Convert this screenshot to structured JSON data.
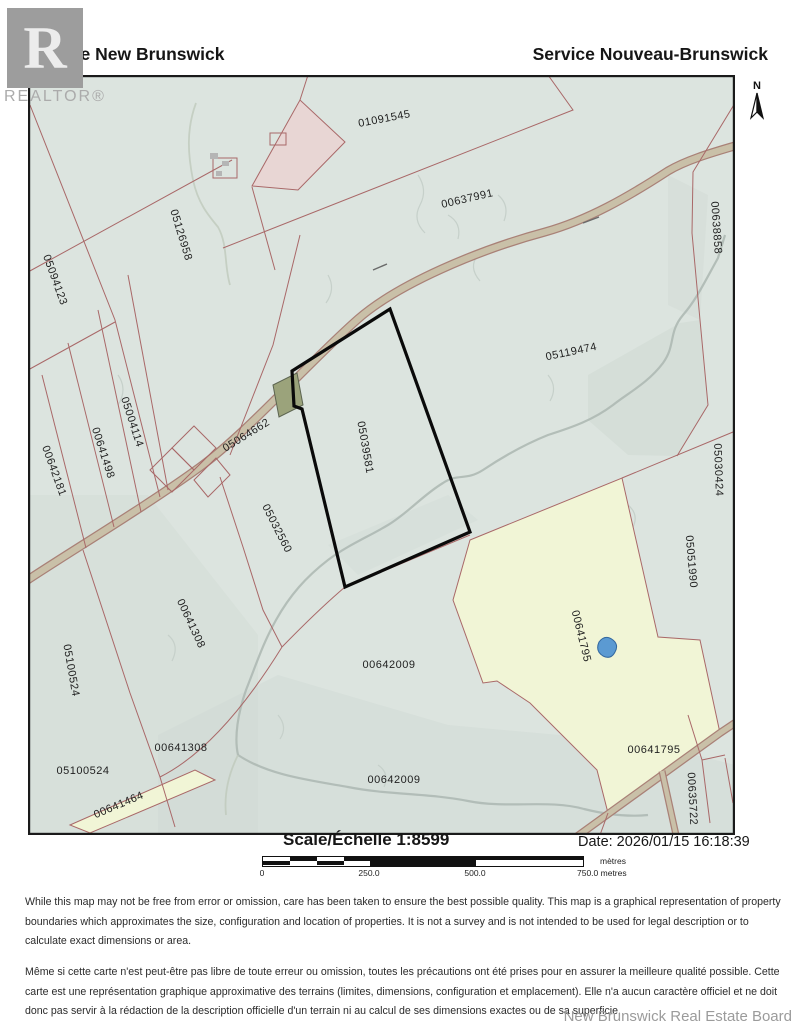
{
  "header": {
    "left_title": "Service New Brunswick",
    "right_title": "Service Nouveau-Brunswick",
    "realtor_letter": "R",
    "realtor_wordmark": "REALTOR®",
    "north_label": "N"
  },
  "map": {
    "subject_parcel_id": "05039581",
    "colors": {
      "c-redline": "#a96868",
      "c-road": "#c9c0a8",
      "c-roadedge": "#a98177",
      "c-subject": "#0a0a0a",
      "c-yellow": "#f1f5d6",
      "c-pink": "#e8d6d4",
      "c-olive": "#9ba37b",
      "c-pond": "#5b9ad2",
      "c-mapbg": "#dce4df"
    },
    "parcel_labels": [
      {
        "text": "01091545",
        "x": 357,
        "y": 47,
        "r": -11
      },
      {
        "text": "00637991",
        "x": 440,
        "y": 127,
        "r": -13
      },
      {
        "text": "00638858",
        "x": 685,
        "y": 153,
        "r": 86
      },
      {
        "text": "05126958",
        "x": 150,
        "y": 161,
        "r": 73
      },
      {
        "text": "05094123",
        "x": 24,
        "y": 206,
        "r": 70
      },
      {
        "text": "05119474",
        "x": 544,
        "y": 280,
        "r": -12
      },
      {
        "text": "05004114",
        "x": 101,
        "y": 348,
        "r": 72
      },
      {
        "text": "00641498",
        "x": 72,
        "y": 379,
        "r": 72
      },
      {
        "text": "00642181",
        "x": 23,
        "y": 397,
        "r": 70
      },
      {
        "text": "05064662",
        "x": 220,
        "y": 363,
        "r": -32
      },
      {
        "text": "05039581",
        "x": 334,
        "y": 373,
        "r": 80
      },
      {
        "text": "05030424",
        "x": 687,
        "y": 395,
        "r": 88
      },
      {
        "text": "05032560",
        "x": 246,
        "y": 455,
        "r": 63
      },
      {
        "text": "05051990",
        "x": 660,
        "y": 487,
        "r": 85
      },
      {
        "text": "00641308",
        "x": 160,
        "y": 550,
        "r": 65
      },
      {
        "text": "00641795",
        "x": 550,
        "y": 562,
        "r": 76
      },
      {
        "text": "05100524",
        "x": 40,
        "y": 596,
        "r": 80
      },
      {
        "text": "00642009",
        "x": 361,
        "y": 593,
        "r": 0
      },
      {
        "text": "00641308",
        "x": 153,
        "y": 676,
        "r": 0
      },
      {
        "text": "05100524",
        "x": 55,
        "y": 699,
        "r": 0
      },
      {
        "text": "00641464",
        "x": 92,
        "y": 733,
        "r": -23
      },
      {
        "text": "00641795",
        "x": 626,
        "y": 678,
        "r": 0
      },
      {
        "text": "00635722",
        "x": 661,
        "y": 724,
        "r": 87
      },
      {
        "text": "00642009",
        "x": 366,
        "y": 708,
        "r": 0
      }
    ]
  },
  "scale_bar": {
    "label": "Scale/Échelle  1:8599",
    "date_label": "Date: 2026/01/15 16:18:39",
    "ticks": [
      "0",
      "250.0",
      "500.0"
    ],
    "end_tick": "750.0 metres",
    "unit_top": "mètres"
  },
  "disclaimer": {
    "english": "While this map may not be free from error or omission, care has been taken to ensure the best possible quality. This map is a graphical representation of property boundaries which approximates the size, configuration and location of properties.  It is not a survey and is not intended to be used for legal description or to calculate exact dimensions or area.",
    "french": "Même si cette carte n'est peut-être pas libre de toute erreur ou omission, toutes les précautions ont été prises pour en assurer la meilleure qualité possible. Cette carte est une représentation graphique approximative des terrains (limites, dimensions, configuration et emplacement). Elle n'a aucun caractère officiel et ne doit donc pas servir à la rédaction de la description officielle d'un terrain ni au calcul de ses dimensions exactes ou de sa superficie.",
    "footer": "New Brunswick Real Estate Board"
  }
}
